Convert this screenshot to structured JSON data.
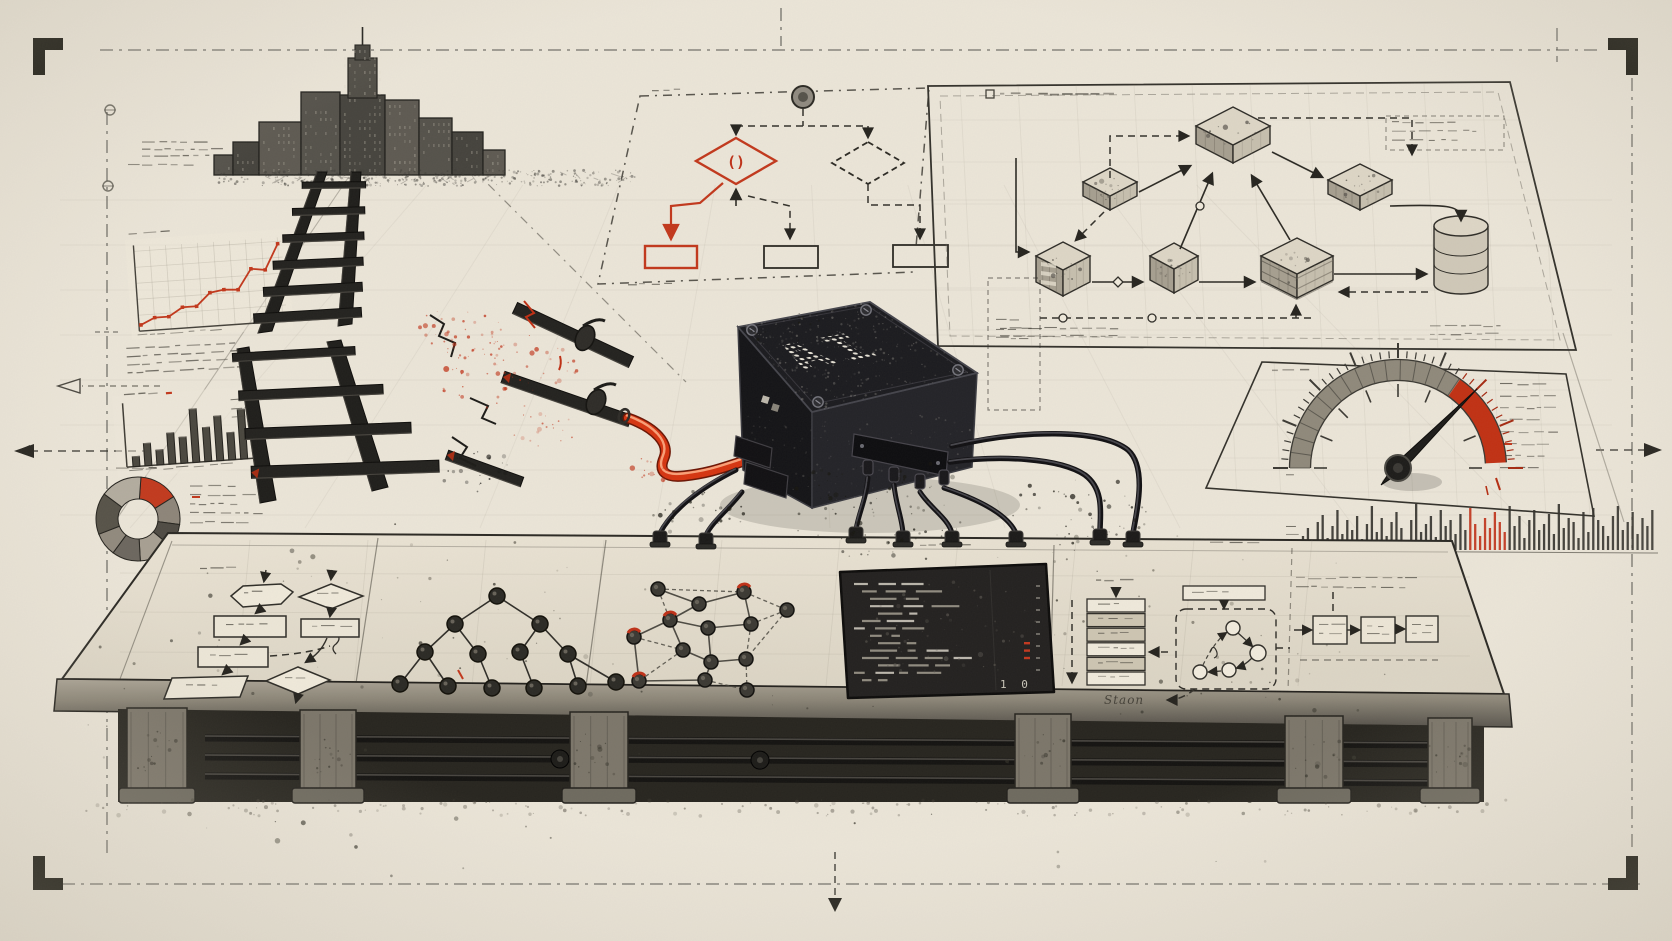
{
  "scene": {
    "type": "hand-drawn blueprint illustration of an AI black-box device",
    "ai_label": "AI",
    "diamond_glyph": "()",
    "stack_caption": "Staon",
    "terminal_footer": "1 0",
    "elements": [
      "city-skyline",
      "broken-railway-track",
      "red-power-cable",
      "ai-black-box",
      "decision-flowchart",
      "isometric-architecture-diagram",
      "risk-gauge",
      "line-chart",
      "bar-chart",
      "donut-chart",
      "activity-histogram",
      "workbench-table",
      "binary-tree-diagram",
      "network-graph",
      "code-terminal",
      "stack-list",
      "state-machine-diagram",
      "pipeline-boxes",
      "crop-marks",
      "drafting-guides",
      "ink-splatter"
    ]
  },
  "palette": {
    "paper": "#ebe5d8",
    "ink": "#22211d",
    "gray": "#6f6a60",
    "red": "#c2381c",
    "red_bright": "#d63511",
    "panel": "#e7e0d2",
    "terminal_bg": "#232120",
    "table_edge_top": "#aaa395",
    "table_edge_bottom": "#55514a"
  },
  "chart_data": [
    {
      "id": "trend-line",
      "type": "line",
      "title": "",
      "x": [
        0,
        1,
        2,
        3,
        4,
        5,
        6,
        7,
        8,
        9,
        10
      ],
      "y": [
        4,
        10,
        10,
        18,
        18,
        30,
        32,
        31,
        50,
        48,
        72
      ],
      "color": "#c2381c",
      "legend_position": "none",
      "note": "rising stepped red line with square markers, sketched panel top-left"
    },
    {
      "id": "bar-chart",
      "type": "bar",
      "values": [
        16,
        36,
        24,
        50,
        42,
        86,
        55,
        72,
        44,
        80
      ],
      "color": "#4a473f",
      "note": "ten gray bars, sketched panel left side"
    },
    {
      "id": "donut-chart",
      "type": "pie",
      "segments": [
        {
          "value": 15,
          "color": "#c23a1e"
        },
        {
          "value": 11,
          "color": "#8d8579"
        },
        {
          "value": 9,
          "color": "#4f4b44"
        },
        {
          "value": 13,
          "color": "#a79f92"
        },
        {
          "value": 11,
          "color": "#6c675f"
        },
        {
          "value": 9,
          "color": "#918a7e"
        },
        {
          "value": 16,
          "color": "#575349"
        },
        {
          "value": 16,
          "color": "#b3ac9f"
        }
      ],
      "note": "donut with one red segment upper-right"
    },
    {
      "id": "risk-gauge",
      "type": "gauge",
      "min_angle": 180,
      "max_angle": 0,
      "red_zone_start_deg": 55,
      "red_zone_end_deg": 3,
      "needle_deg": 45,
      "note": "semicircular gauge, needle pointing into red zone"
    },
    {
      "id": "activity-histogram",
      "type": "bar",
      "values": [
        14,
        22,
        9,
        28,
        35,
        12,
        24,
        40,
        16,
        30,
        20,
        34,
        11,
        26,
        44,
        18,
        32,
        14,
        28,
        38,
        22,
        10,
        30,
        46,
        18,
        26,
        34,
        13,
        40,
        24,
        30,
        16,
        36,
        20,
        42,
        26,
        14,
        32,
        22,
        38,
        28,
        18,
        44,
        24,
        34,
        12,
        30,
        40,
        20,
        26,
        36,
        16,
        46,
        22,
        32,
        28,
        12,
        38,
        18,
        42,
        30,
        24,
        14,
        34,
        44,
        20,
        28,
        38,
        16,
        32,
        24,
        40
      ],
      "red_from": 34,
      "red_to": 41,
      "note": "dense thin-bar strip under gauge, red cluster right of middle"
    }
  ],
  "city": {
    "baseline_y": 175,
    "buildings": [
      {
        "x": 214,
        "w": 19,
        "h": 20
      },
      {
        "x": 233,
        "w": 26,
        "h": 33
      },
      {
        "x": 259,
        "w": 42,
        "h": 53
      },
      {
        "x": 301,
        "w": 39,
        "h": 83
      },
      {
        "x": 340,
        "w": 45,
        "h": 130,
        "spire": true
      },
      {
        "x": 385,
        "w": 34,
        "h": 75
      },
      {
        "x": 419,
        "w": 33,
        "h": 57
      },
      {
        "x": 452,
        "w": 31,
        "h": 43
      },
      {
        "x": 483,
        "w": 22,
        "h": 25
      }
    ]
  },
  "ladder": {
    "broken": true,
    "rungs_upper": 6,
    "rungs_lower": 4,
    "loose_pieces": 3
  },
  "architecture": {
    "components": [
      "cube-hub",
      "cube-small",
      "cube-right",
      "server-box",
      "module-box",
      "layered-store",
      "database-cylinder"
    ],
    "connector_styles": [
      "solid-arrow",
      "dashed-arrow",
      "junction-node"
    ]
  },
  "workbench": {
    "tree": {
      "root": [
        497,
        596
      ],
      "children": [
        [
          455,
          624
        ],
        [
          540,
          624
        ]
      ],
      "grandchildren": [
        [
          425,
          652
        ],
        [
          478,
          654
        ],
        [
          520,
          652
        ],
        [
          568,
          654
        ]
      ],
      "leaves": [
        [
          400,
          684
        ],
        [
          448,
          686
        ],
        [
          492,
          688
        ],
        [
          534,
          688
        ],
        [
          578,
          686
        ],
        [
          616,
          682
        ]
      ],
      "leaf_parent": [
        0,
        0,
        1,
        2,
        3,
        3
      ]
    },
    "network": {
      "nodes": [
        {
          "x": 658,
          "y": 589
        },
        {
          "x": 699,
          "y": 604
        },
        {
          "x": 744,
          "y": 592,
          "red": true
        },
        {
          "x": 787,
          "y": 610
        },
        {
          "x": 670,
          "y": 620,
          "red": true
        },
        {
          "x": 634,
          "y": 637,
          "red": true
        },
        {
          "x": 708,
          "y": 628
        },
        {
          "x": 751,
          "y": 624
        },
        {
          "x": 683,
          "y": 650
        },
        {
          "x": 711,
          "y": 662
        },
        {
          "x": 746,
          "y": 659
        },
        {
          "x": 639,
          "y": 681,
          "red": true
        },
        {
          "x": 705,
          "y": 680
        },
        {
          "x": 747,
          "y": 690
        }
      ],
      "solid_edges": [
        [
          0,
          1
        ],
        [
          1,
          2
        ],
        [
          1,
          4
        ],
        [
          4,
          5
        ],
        [
          4,
          6
        ],
        [
          6,
          7
        ],
        [
          6,
          9
        ],
        [
          8,
          9
        ],
        [
          9,
          12
        ],
        [
          5,
          11
        ],
        [
          11,
          12
        ],
        [
          9,
          10
        ],
        [
          2,
          7
        ],
        [
          4,
          8
        ]
      ],
      "dashed_edges": [
        [
          0,
          4
        ],
        [
          2,
          3
        ],
        [
          3,
          7
        ],
        [
          7,
          10
        ],
        [
          10,
          13
        ],
        [
          12,
          13
        ],
        [
          5,
          8
        ],
        [
          0,
          2
        ],
        [
          3,
          10
        ],
        [
          8,
          11
        ]
      ]
    },
    "stack": {
      "rows_shaded": [
        false,
        true,
        true,
        false,
        true,
        false
      ]
    },
    "terminal": {
      "line_count": 14,
      "red_mark_rows": [
        8,
        9,
        10
      ]
    },
    "pipeline": {
      "stages": 3
    }
  }
}
